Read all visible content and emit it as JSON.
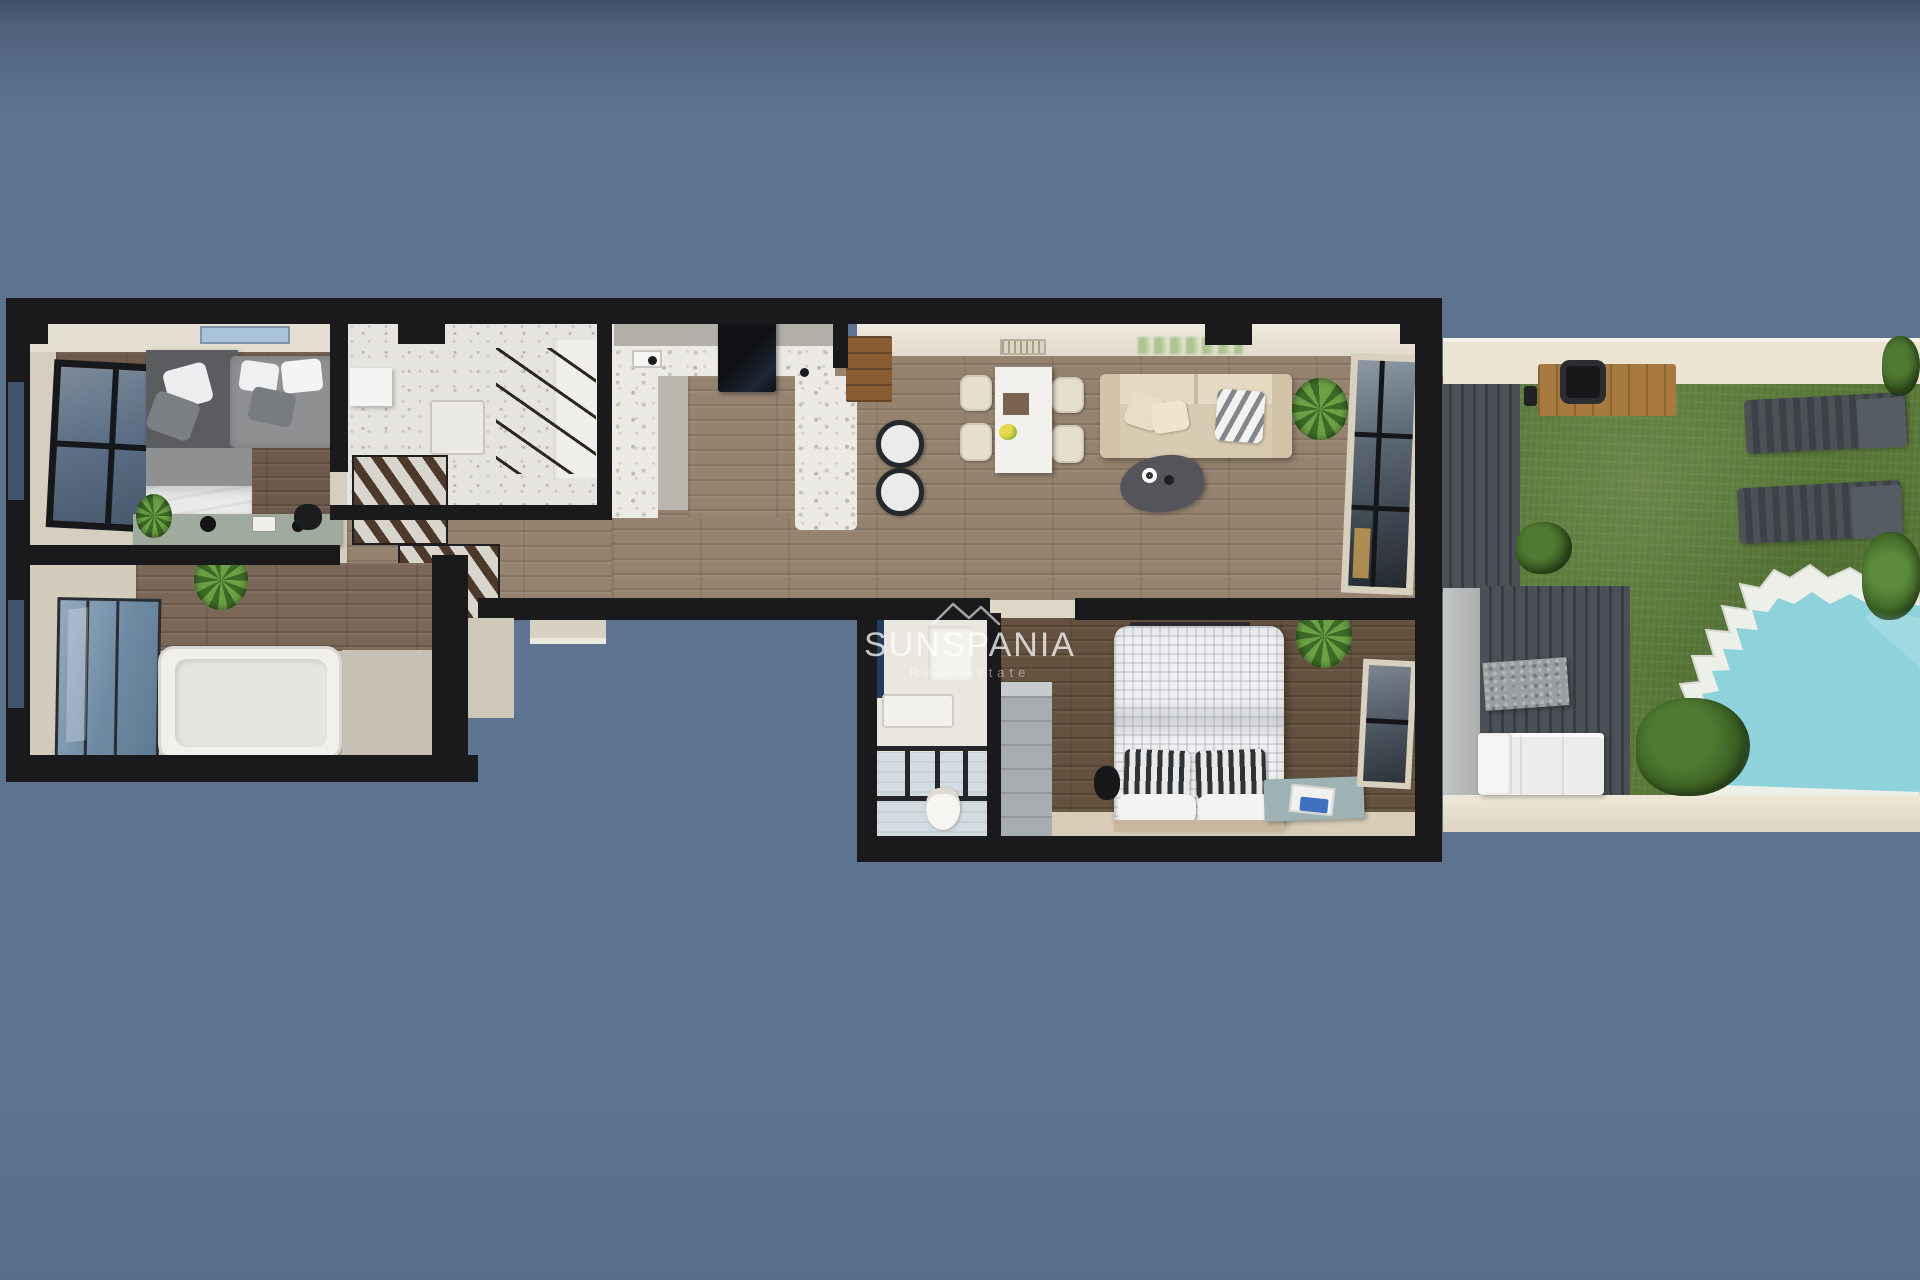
{
  "watermark": {
    "brand": "SUNSPANIA",
    "tagline": "Real estate",
    "logo": "mountain-roofline-icon",
    "text_color": "#ffffff"
  },
  "scene": {
    "type": "3d-floor-plan-top-down-render",
    "palette": {
      "background": "#5d7491",
      "background_top": "#42506a",
      "wall": "#1a1a1c",
      "wood_floor_light": "#95826f",
      "wood_floor_dark": "#6e5a4b",
      "terrazzo_counter": "#eceae4",
      "grass": "#5c7c3a",
      "pool_water": "#8ed2dc",
      "pool_deck": "#edefe9",
      "terrace_wall_cream": "#ece4d3",
      "pergola_louvre": "#43484e",
      "sofa_cream": "#d9cbb1",
      "shower_glass_blue": "#7f9cb4",
      "bench_teal": "#9cb2b4",
      "plant_green": "#5d9140"
    },
    "rooms": [
      {
        "name": "secondary-bedroom",
        "items": [
          "corner-twin-beds",
          "gray-duvets",
          "white-pillows",
          "dark-headboard-canopy",
          "skylight",
          "side-window",
          "sideboard-desk",
          "potted-plant",
          "desk-lamp"
        ]
      },
      {
        "name": "walk-in-closet",
        "items": [
          "clothes-rails",
          "wall-cabinet",
          "white-side-table"
        ]
      },
      {
        "name": "kitchen",
        "items": [
          "u-shaped-terrazzo-counter",
          "black-fridge-column",
          "sink",
          "bar-cabinet",
          "two-bar-stools"
        ]
      },
      {
        "name": "living-dining-room",
        "items": [
          "white-dining-table",
          "four-cream-chairs",
          "fruit-bowl",
          "cream-sofa",
          "chevron-pillow",
          "dark-gray-rug",
          "white-cup",
          "potted-plant",
          "tall-window",
          "wall-vent",
          "green-wall-planting"
        ]
      },
      {
        "name": "hallway",
        "items": [
          "slatted-wood-staircase"
        ]
      },
      {
        "name": "family-bathroom",
        "items": [
          "bathtub",
          "blue-glass-shower",
          "potted-plant"
        ]
      },
      {
        "name": "master-bedroom",
        "items": [
          "double-bed-waffle-duvet",
          "striped-pillows",
          "teal-bench",
          "laptop-tray",
          "wardrobe",
          "potted-plant",
          "window"
        ]
      },
      {
        "name": "ensuite-bathroom",
        "items": [
          "walk-in-shower",
          "glass-screen",
          "vanity-sink",
          "mirror",
          "toilet"
        ]
      }
    ],
    "outdoor": [
      {
        "name": "garden",
        "items": [
          "lawn",
          "two-sun-loungers",
          "wooden-table",
          "black-chair",
          "bushes",
          "palm-plant"
        ]
      },
      {
        "name": "pool-area",
        "items": [
          "scalloped-white-deck",
          "turquoise-pool"
        ]
      },
      {
        "name": "pergola-terrace",
        "items": [
          "louvred-canopy",
          "outdoor-white-sofa",
          "stone-coffee-table",
          "pillar"
        ]
      }
    ]
  }
}
